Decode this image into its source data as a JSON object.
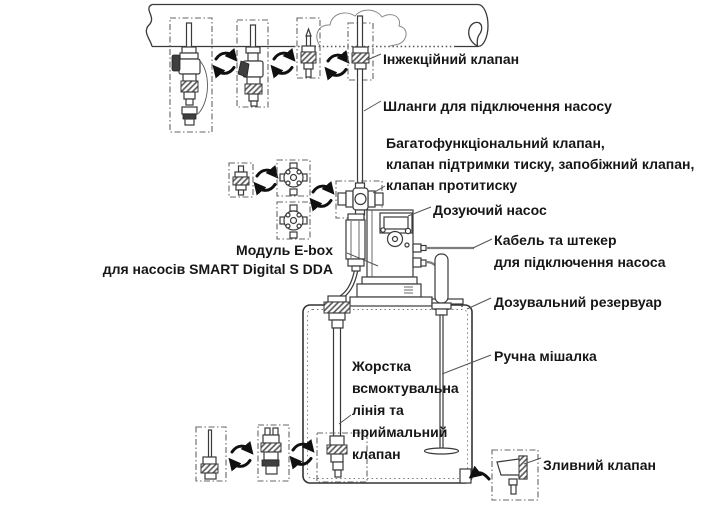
{
  "diagram": {
    "type": "dosing-pump-installation-schematic",
    "labels": {
      "injection_valve": "Інжекційний клапан",
      "hoses": "Шланги для підключення насосу",
      "multifunction_valve": "Багатофункціональний клапан,\nклапан підтримки тиску, запобіжний клапан,\nклапан протитиску",
      "dosing_pump": "Дозуючий насос",
      "cable": "Кабель та штекер\nдля підключення насоса",
      "ebox": "Модуль E-box\nдля насосів SMART Digital S DDA",
      "reservoir": "Дозувальний резервуар",
      "mixer": "Ручна мішалка",
      "suction_line": "Жорстка\nвсмоктувальна\nлінія та\nприймальний\nклапан",
      "drain_valve": "Зливний клапан"
    },
    "icons": {
      "swap_arrows_icon": "⇄",
      "drain_arrow_icon": "←"
    },
    "colors": {
      "line": "#3a3a3a",
      "text": "#161616",
      "background": "#ffffff"
    }
  }
}
